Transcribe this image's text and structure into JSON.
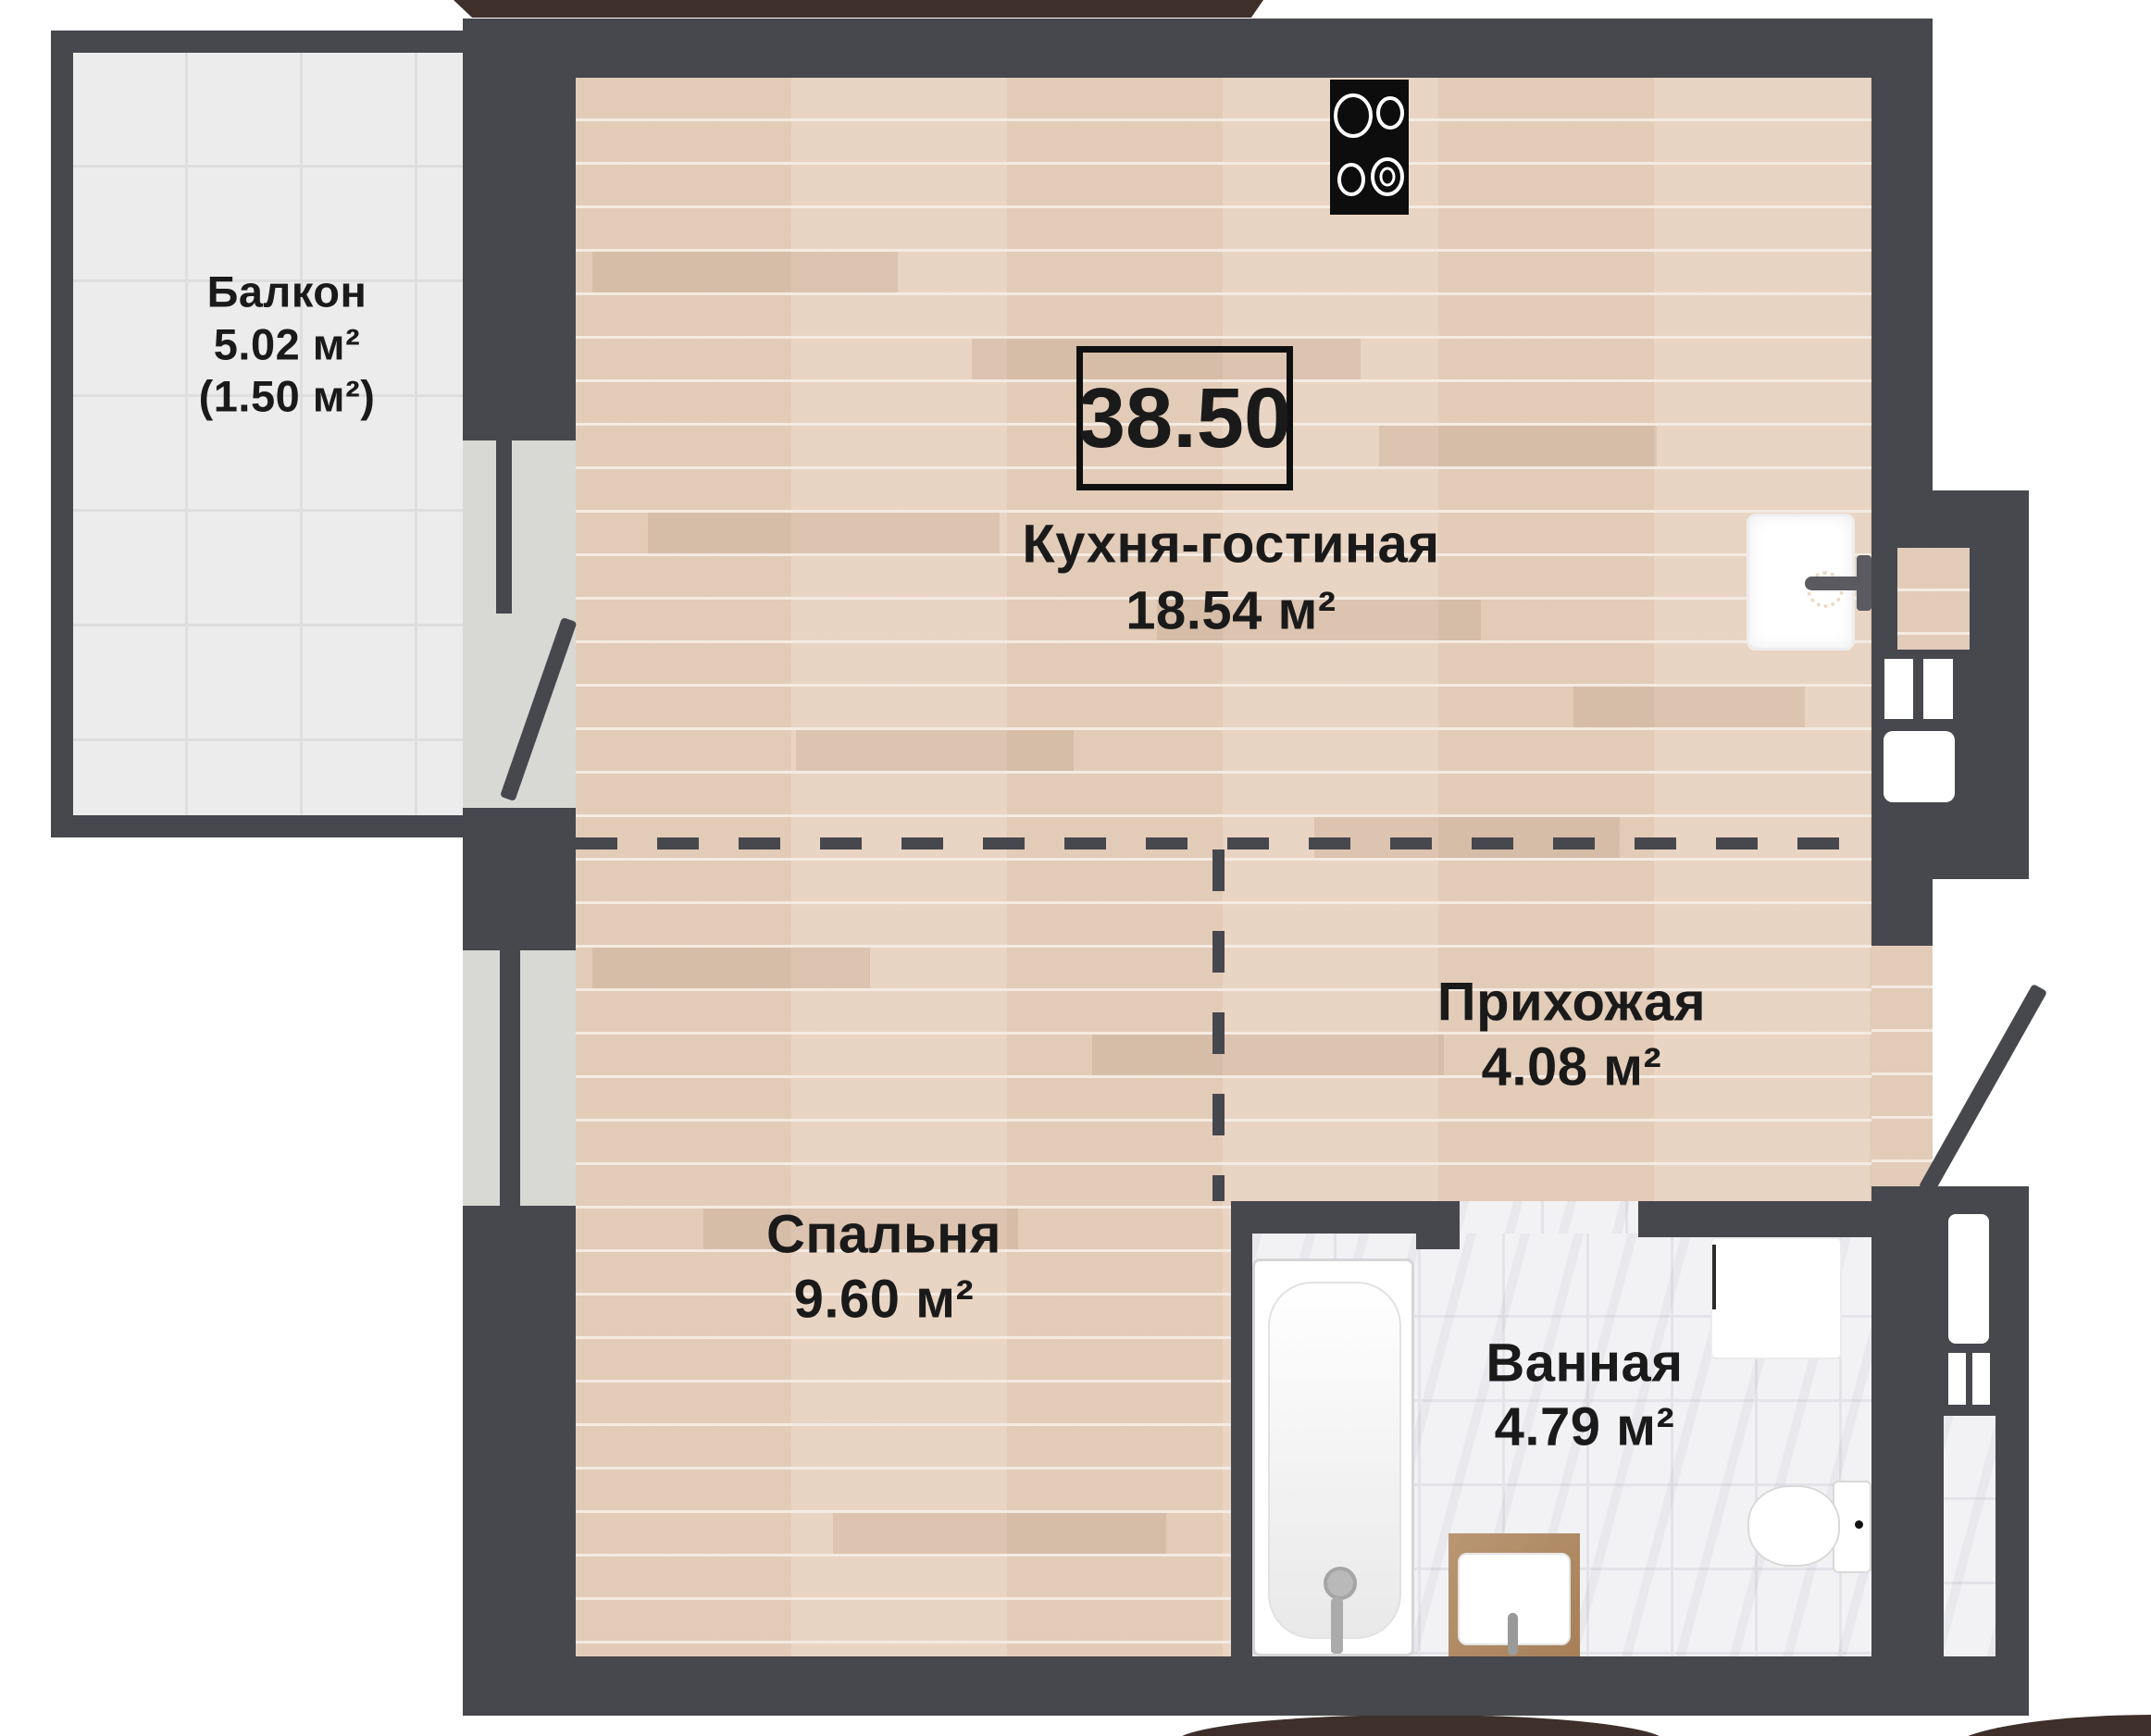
{
  "title": "Floor plan of apartment 38.50 m2",
  "total_area": {
    "value": "38.50"
  },
  "rooms": {
    "balcony": {
      "name": "Балкон",
      "area": "5.02 м²",
      "area_reduced": "(1.50 м²)"
    },
    "kitchen_living": {
      "name": "Кухня-гостиная",
      "area": "18.54 м²"
    },
    "hallway": {
      "name": "Прихожая",
      "area": "4.08 м²"
    },
    "bedroom": {
      "name": "Спальня",
      "area": "9.60 м²"
    },
    "bathroom": {
      "name": "Ванная",
      "area": "4.79 м²"
    }
  },
  "icons": {
    "stove": "stove-cooktop-icon",
    "kitchen_sink": "kitchen-sink-icon",
    "bathtub": "bathtub-icon",
    "vanity_sink": "vanity-sink-icon",
    "toilet": "toilet-icon",
    "washing_machine": "washing-machine-icon",
    "entrance_door": "entrance-door-leaf",
    "balcony_door": "balcony-door-leaf"
  },
  "colors": {
    "wall": "#47474e",
    "building_fragment_brown": "#3e2f2a",
    "wood_floor": "#e8d2bf",
    "balcony_tile": "#ececec",
    "marble_tile": "#f2f2f5",
    "window_glass": "#d8d8d4",
    "stove_black": "#0d0d0d",
    "text": "#1a1a1a"
  }
}
